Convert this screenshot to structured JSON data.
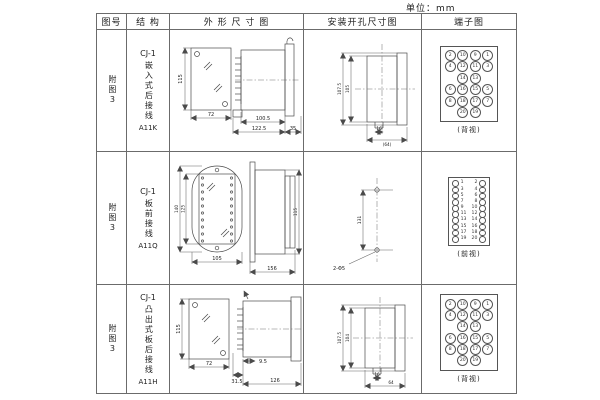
{
  "unit_label": "单位：mm",
  "headers": {
    "fig_no": "图号",
    "structure": "结 构",
    "outline": "外 形 尺 寸 图",
    "install": "安装开孔尺寸图",
    "terminal": "端子图"
  },
  "rows": [
    {
      "fig": "附图3",
      "model": "CJ-1",
      "structure": "嵌入式后接线",
      "code": "A11K",
      "outline": {
        "height": "115",
        "width": "72",
        "len1": "100.5",
        "len2": "122.5",
        "flange": "35"
      },
      "install": {
        "v1": "107.5",
        "v2": "105",
        "h1": "16",
        "h2": "(64)"
      },
      "terminal": {
        "label": "(背视)",
        "rows": [
          [
            2,
            10,
            9,
            1
          ],
          [
            4,
            12,
            11,
            3
          ],
          [
            null,
            14,
            13,
            null
          ],
          [
            6,
            16,
            15,
            5
          ],
          [
            8,
            18,
            17,
            7
          ],
          [
            null,
            20,
            19,
            null
          ]
        ]
      }
    },
    {
      "fig": "附图3",
      "model": "CJ-1",
      "structure": "板前接线",
      "code": "A11Q",
      "outline": {
        "h_outer": "140",
        "h_inner": "125",
        "width": "105",
        "len": "156",
        "side_h": "115"
      },
      "install": {
        "v": "131",
        "holes": "2-Φ5"
      },
      "terminal": {
        "label": "(前视)",
        "pairs": [
          [
            1,
            2
          ],
          [
            3,
            4
          ],
          [
            5,
            6
          ],
          [
            7,
            8
          ],
          [
            9,
            10
          ],
          [
            11,
            12
          ],
          [
            13,
            14
          ],
          [
            15,
            16
          ],
          [
            17,
            18
          ],
          [
            19,
            20
          ]
        ]
      }
    },
    {
      "fig": "附图3",
      "model": "CJ-1",
      "structure": "凸出式板后接线",
      "code": "A11H",
      "outline": {
        "height": "115",
        "width": "72",
        "pin": "31.5",
        "gap": "9.5",
        "len": "126"
      },
      "install": {
        "v1": "107.5",
        "v2": "104",
        "h1": "16",
        "h2": "64"
      },
      "terminal": {
        "label": "(背视)",
        "rows": [
          [
            2,
            10,
            9,
            1
          ],
          [
            4,
            12,
            11,
            3
          ],
          [
            null,
            14,
            13,
            null
          ],
          [
            6,
            16,
            15,
            5
          ],
          [
            8,
            18,
            17,
            7
          ],
          [
            null,
            20,
            19,
            null
          ]
        ]
      }
    }
  ]
}
